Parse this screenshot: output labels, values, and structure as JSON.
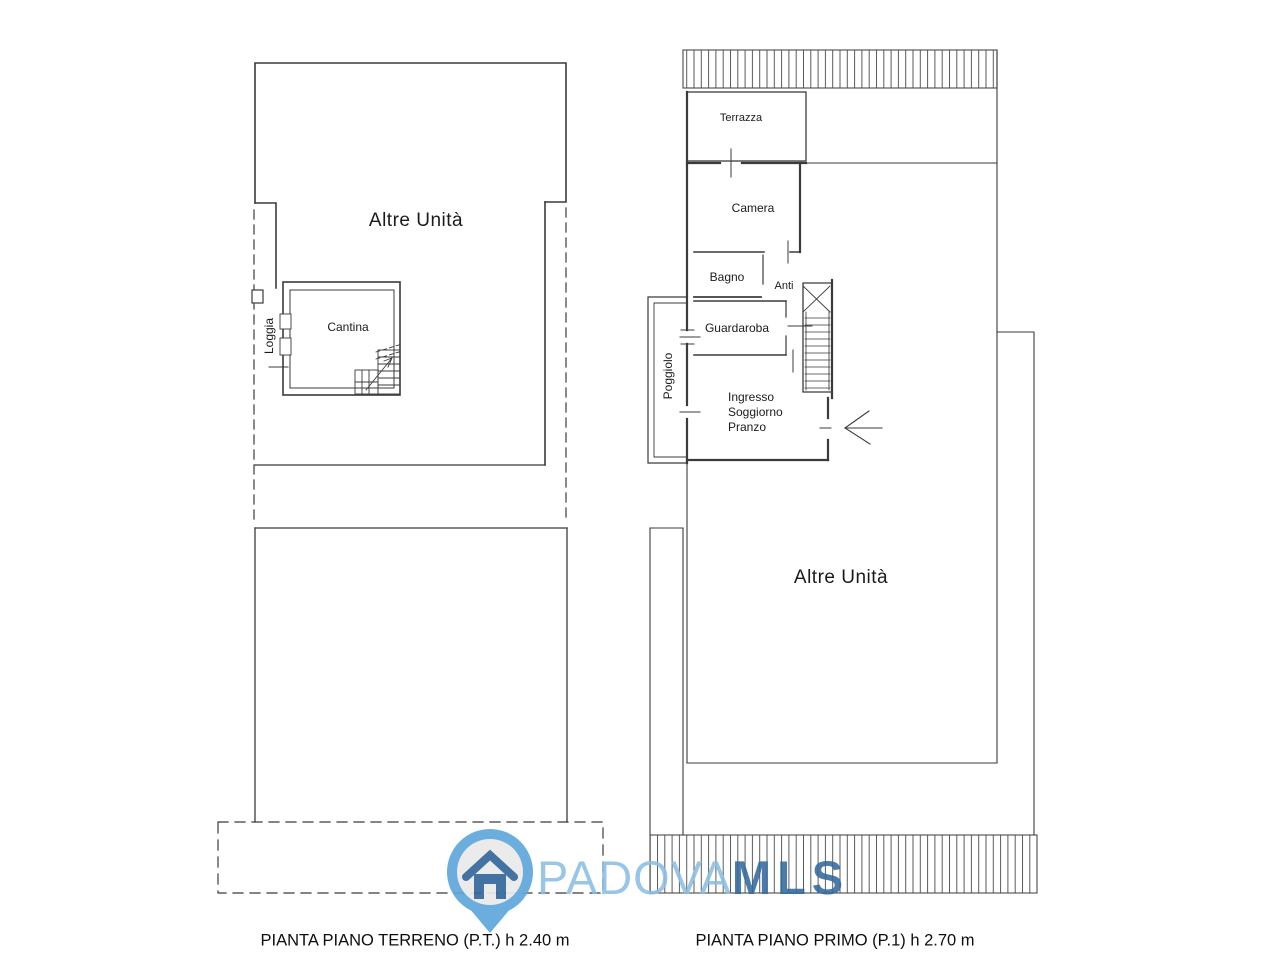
{
  "document": {
    "type": "real-estate floor plan",
    "background": "#ffffff",
    "line_color": "#3b3b3b"
  },
  "ground_floor": {
    "caption": "PIANTA PIANO TERRENO (P.T.) h 2.40 m",
    "labels": {
      "altre_unita": "Altre Unità",
      "loggia": "Loggia",
      "cantina": "Cantina"
    }
  },
  "first_floor": {
    "caption": "PIANTA PIANO PRIMO (P.1) h 2.70 m",
    "labels": {
      "terrazza": "Terrazza",
      "camera": "Camera",
      "bagno": "Bagno",
      "anti": "Anti",
      "guardaroba": "Guardaroba",
      "poggiolo": "Poggiolo",
      "ingresso_line1": "Ingresso",
      "ingresso_line2": "Soggiorno",
      "ingresso_line3": "Pranzo",
      "altre_unita": "Altre Unità"
    }
  },
  "watermark": {
    "brand_light": "PADOVA",
    "brand_bold": "MLS",
    "colors": {
      "pin": "#5FA8DC",
      "pin_inner": "#EAEAEA",
      "house": "#34689C",
      "text_light": "#8CBEE4",
      "text_bold": "#336A9E"
    }
  }
}
